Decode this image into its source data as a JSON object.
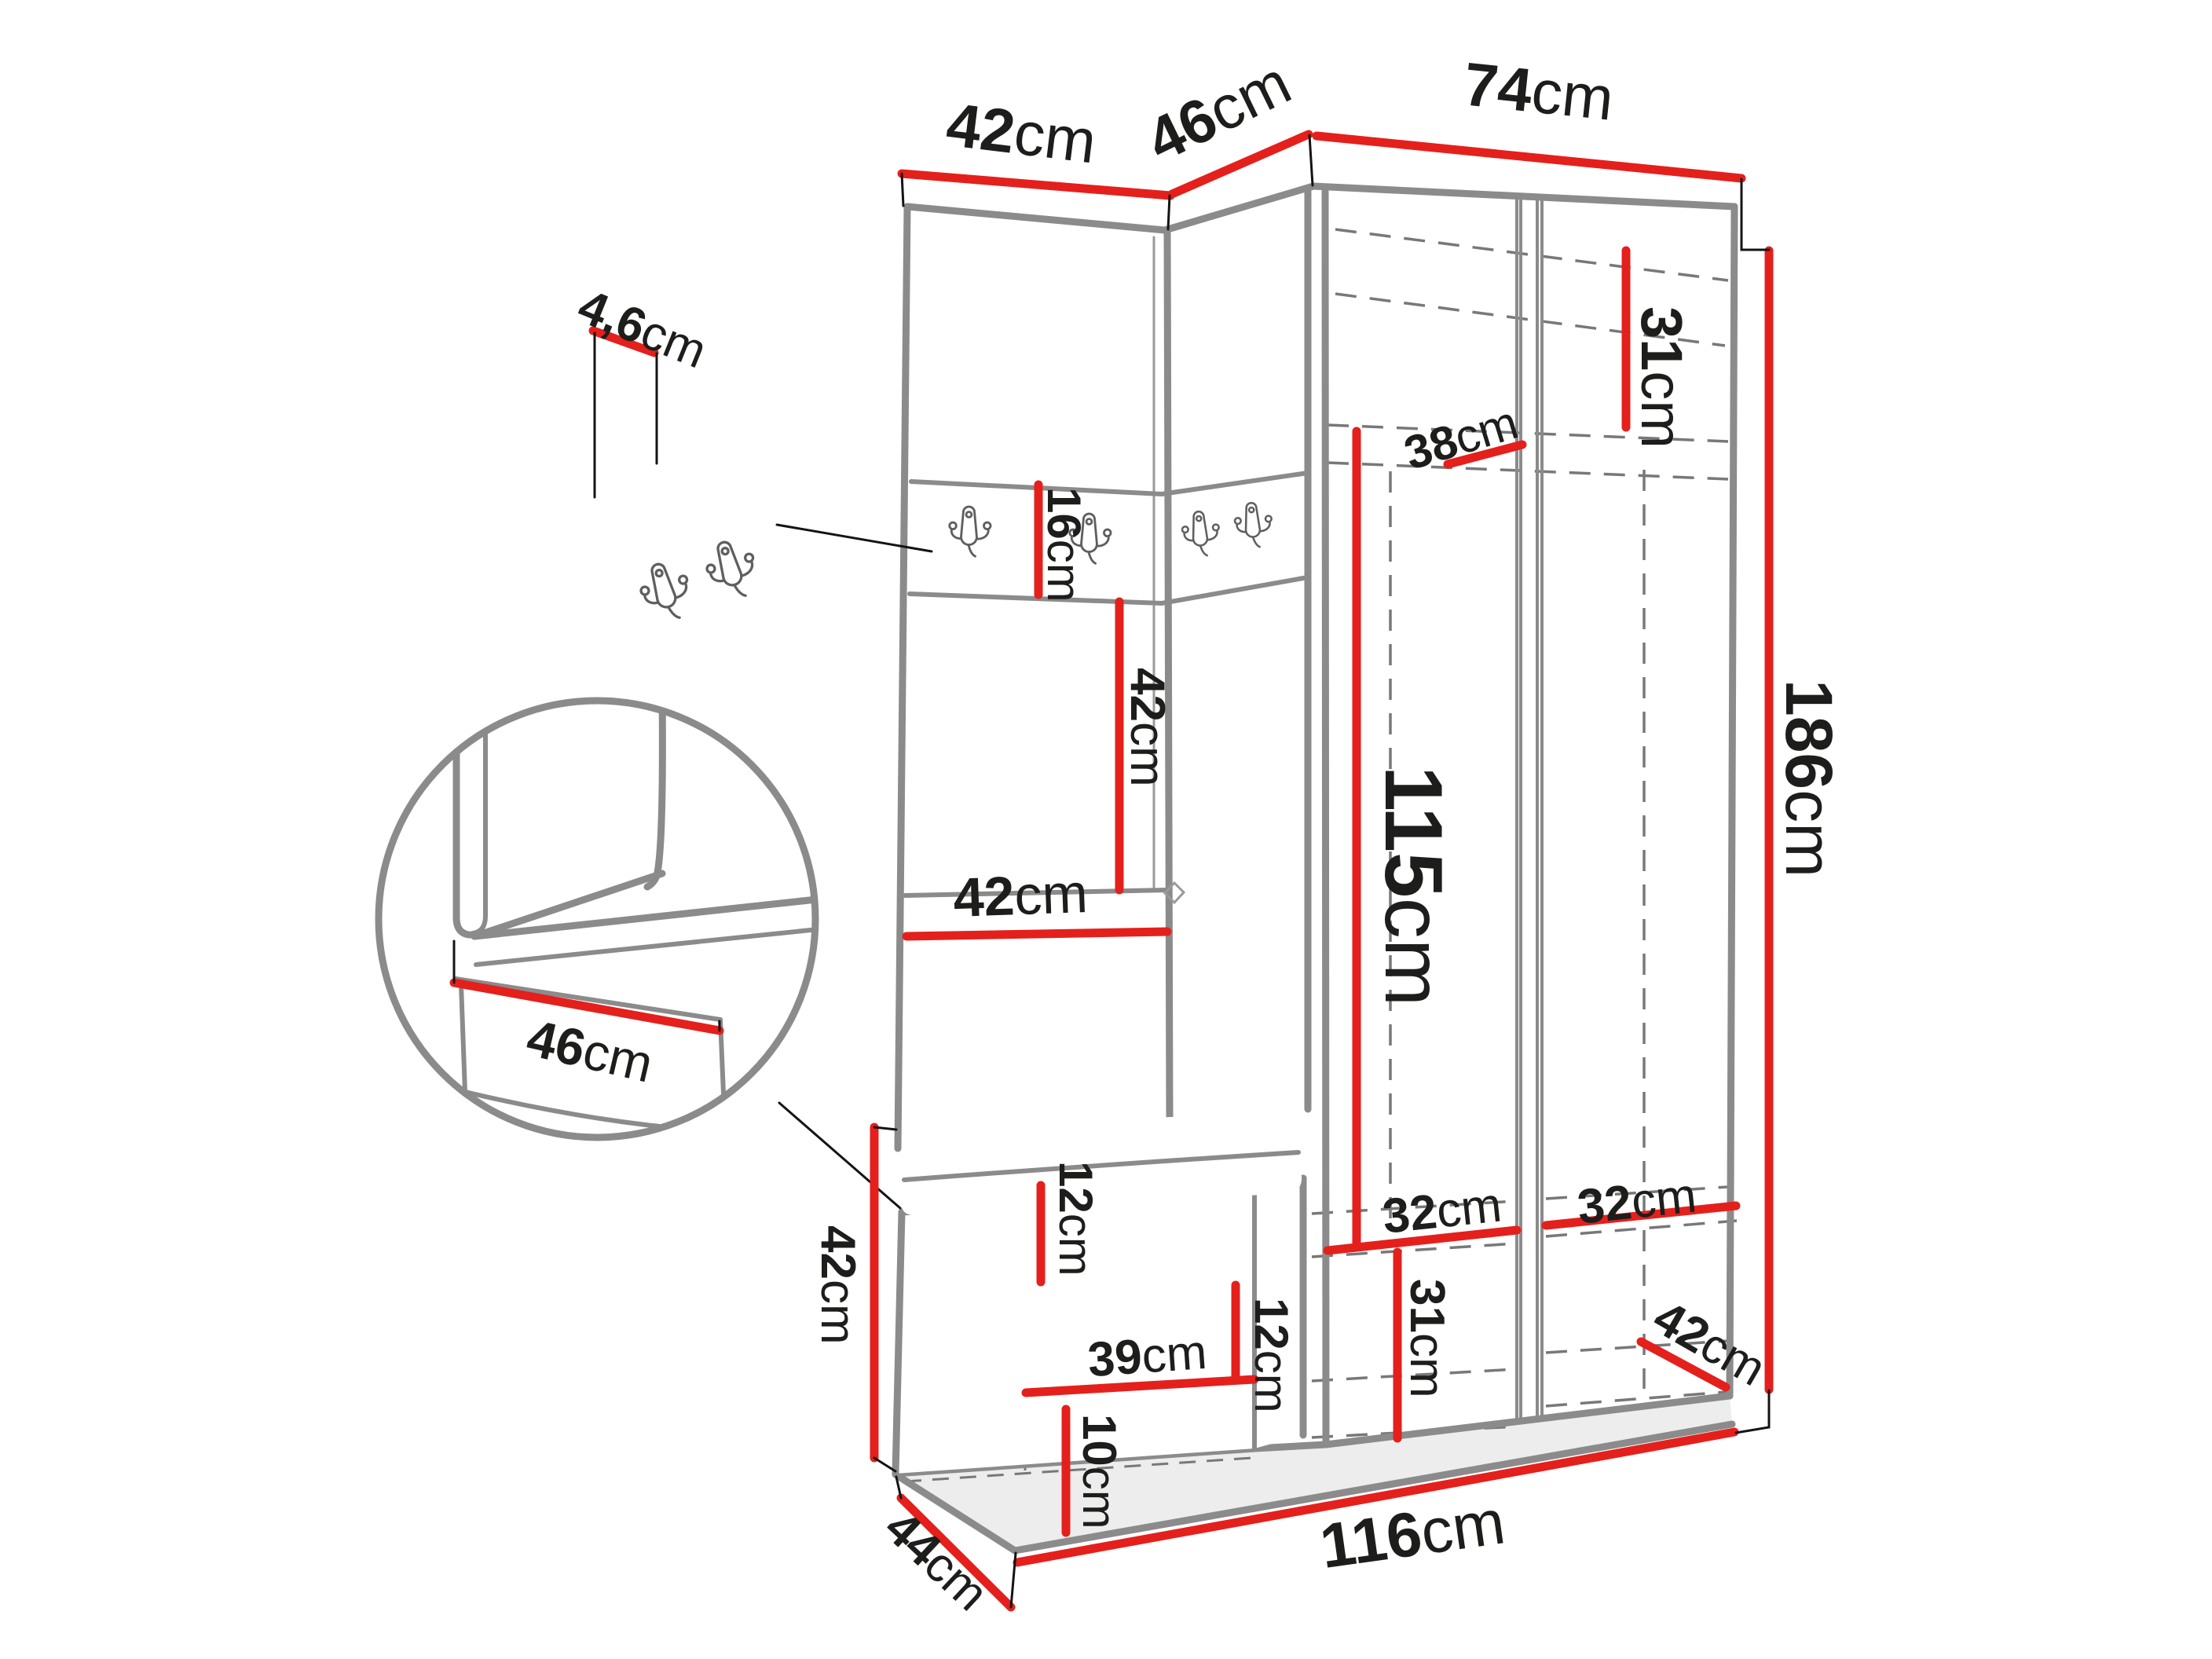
{
  "diagram": {
    "type": "furniture-dimension-diagram",
    "subject": "corner hallway wardrobe set with coat-hook panels, corner bench and wardrobe cabinet",
    "unit": "cm",
    "colors": {
      "dimension_line": "#e4201c",
      "furniture_line": "#8b8b8b",
      "text": "#1d1d1b",
      "background": "#ffffff"
    },
    "details": {
      "hook_panel": "wall panel with two double coat hooks",
      "hook_strip": "hook strip with four double coat hooks",
      "circle_detail": "close-up of corner bench seat"
    },
    "dimensions": {
      "top_left_width": {
        "num": "42",
        "unit": "cm"
      },
      "top_corner_width": {
        "num": "46",
        "unit": "cm"
      },
      "top_right_width": {
        "num": "74",
        "unit": "cm"
      },
      "panel_thickness": {
        "num": "4,6",
        "unit": "cm"
      },
      "hook_strip_height": {
        "num": "16",
        "unit": "cm"
      },
      "upper_shelf_gap": {
        "num": "42",
        "unit": "cm"
      },
      "middle_shelf_width": {
        "num": "42",
        "unit": "cm"
      },
      "top_shelf_depth": {
        "num": "38",
        "unit": "cm"
      },
      "top_compartment_height": {
        "num": "31",
        "unit": "cm"
      },
      "hanging_height": {
        "num": "115",
        "unit": "cm"
      },
      "total_height": {
        "num": "186",
        "unit": "cm"
      },
      "bottom_shelf_left_width": {
        "num": "32",
        "unit": "cm"
      },
      "bottom_shelf_right_width": {
        "num": "32",
        "unit": "cm"
      },
      "bottom_compartment_height": {
        "num": "31",
        "unit": "cm"
      },
      "bottom_depth": {
        "num": "42",
        "unit": "cm"
      },
      "total_width": {
        "num": "116",
        "unit": "cm"
      },
      "bench_height": {
        "num": "42",
        "unit": "cm"
      },
      "bench_depth": {
        "num": "44",
        "unit": "cm"
      },
      "bench_top_thickness": {
        "num": "12",
        "unit": "cm"
      },
      "bench_inner_width": {
        "num": "39",
        "unit": "cm"
      },
      "bench_inner_height": {
        "num": "12",
        "unit": "cm"
      },
      "bench_plinth_height": {
        "num": "10",
        "unit": "cm"
      },
      "seat_depth": {
        "num": "46",
        "unit": "cm"
      }
    }
  }
}
